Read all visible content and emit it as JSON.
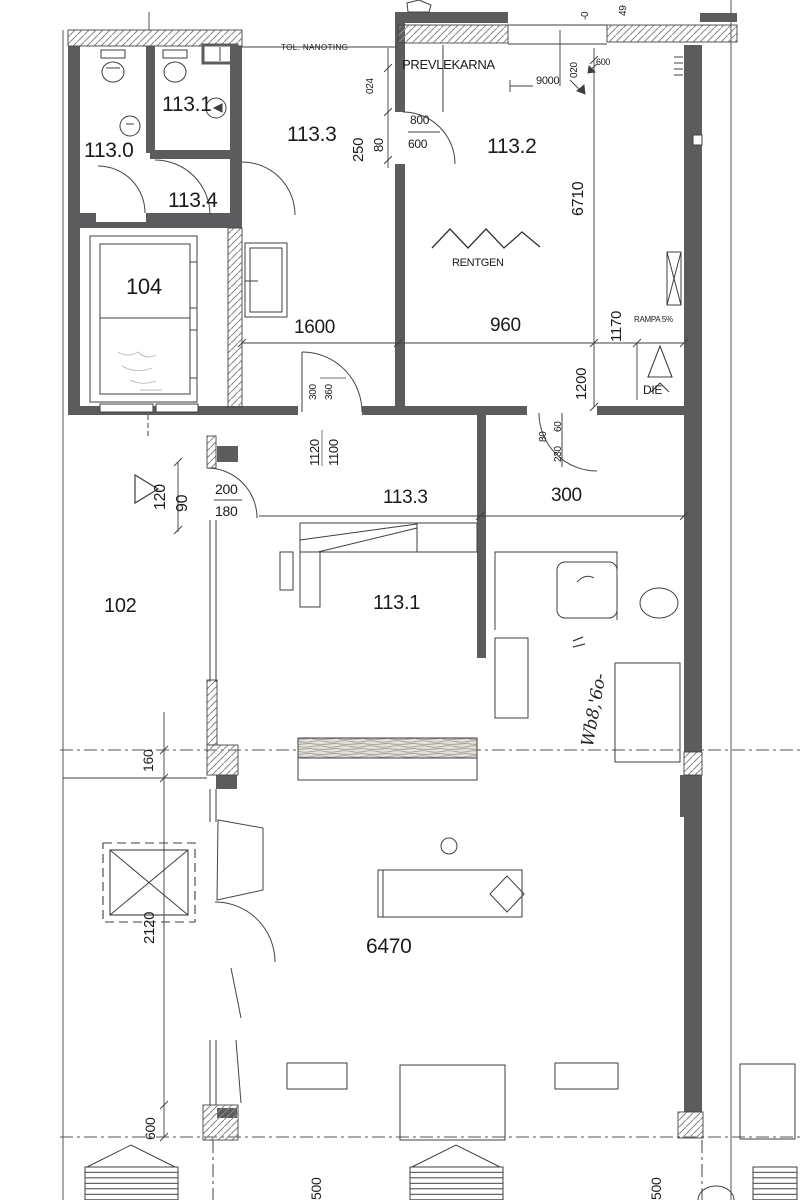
{
  "colors": {
    "wall": "#5c5c5e",
    "line": "#3f3f3f",
    "hatch": "#8a8a8a",
    "text": "#1b1b1b",
    "bg": "#ffffff"
  },
  "rooms": {
    "r113_0": "113.0",
    "r113_1_top": "113.1",
    "r113_4": "113.4",
    "r113_3_top": "113.3",
    "r113_2": "113.2",
    "r104": "104",
    "r102": "102",
    "r113_1": "113.1",
    "r113_3": "113.3"
  },
  "names": {
    "prevlekarna": "PREVLEKARNA",
    "rentgen": "RENTGEN"
  },
  "notes": {
    "tol": "TOL. NANOTING",
    "rampa": "RAMPA 5%",
    "die": "DIE",
    "handwriting": "Wb8,'6o-"
  },
  "dims": {
    "d1600": "1600",
    "d960": "960",
    "d1170": "1170",
    "d1200": "1200",
    "d6710": "6710",
    "d9000": "9000",
    "d020": "020",
    "d024": "024",
    "d250": "250",
    "d80top": "80",
    "d800": "800",
    "d600door": "600",
    "d600top": "600",
    "d300door": "300",
    "d360door": "360",
    "d1120": "1120",
    "d1100": "1100",
    "d80mid": "80",
    "d60mid": "60",
    "d230mid": "230",
    "d120": "120",
    "d90": "90",
    "d200": "200",
    "d180": "180",
    "d300mid": "300",
    "d160": "160",
    "d2120": "2120",
    "d6470": "6470",
    "d600b": "600",
    "d500l": "500",
    "d500r": "500",
    "dneg0": "-0",
    "d49": "49"
  }
}
